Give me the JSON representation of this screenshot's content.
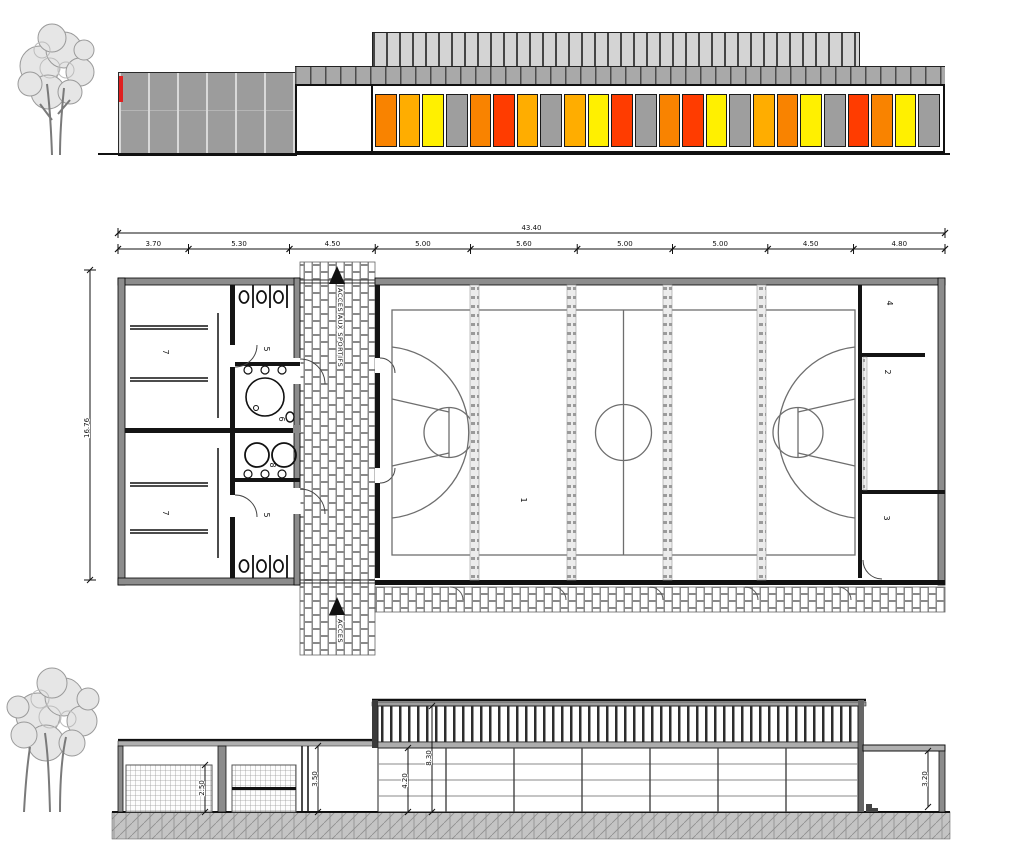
{
  "palette": {
    "orange": "#F98300",
    "amber": "#FFAD00",
    "yellow": "#FFF000",
    "red": "#FF3C00",
    "gray": "#9E9E9E",
    "wall_gray": "#9C9C9C",
    "accent_red": "#E02020"
  },
  "top_elevation": {
    "panels": [
      "orange",
      "amber",
      "yellow",
      "gray",
      "orange",
      "red",
      "amber",
      "gray",
      "amber",
      "yellow",
      "red",
      "gray",
      "orange",
      "red",
      "yellow",
      "gray",
      "amber",
      "orange",
      "yellow",
      "gray",
      "red",
      "orange",
      "yellow",
      "gray"
    ]
  },
  "plan": {
    "total_dim": "43.40",
    "segment_dims": [
      "3.70",
      "5.30",
      "4.50",
      "5.00",
      "5.60",
      "5.00",
      "5.00",
      "4.50",
      "4.80"
    ],
    "height_dim": "16.76",
    "access_top": "ACCES AUX SPORTIFS",
    "access_bottom": "ACCES",
    "rooms": {
      "court": "1",
      "storage_right": "2",
      "storage_bottom_right": "3",
      "room_top_right": "4",
      "wc_top": "5",
      "wc_bottom": "5",
      "shower_room": "6",
      "changing_top": "7",
      "changing_bottom": "7",
      "washbasins": "8"
    }
  },
  "section": {
    "dims": {
      "left_inner": "2.50",
      "left_wall": "3.50",
      "hall_low": "4.20",
      "hall_high": "8.30",
      "right_annex": "3.20"
    }
  }
}
